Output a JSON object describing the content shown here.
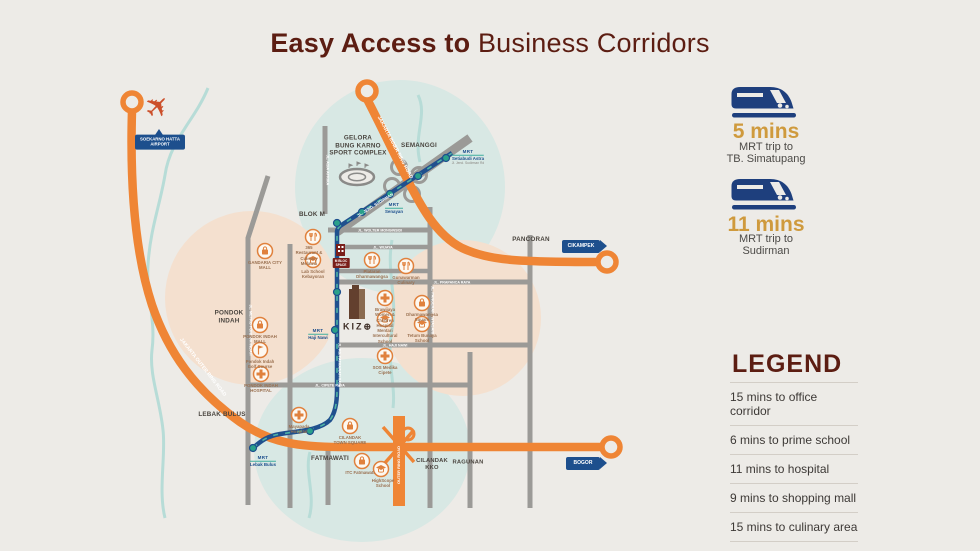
{
  "title": {
    "bold": "Easy Access to",
    "regular": "Business Corridors"
  },
  "right_panel": {
    "trips": [
      {
        "duration": "5 mins",
        "line1": "MRT trip to",
        "line2": "TB. Simatupang",
        "icon": "train-icon"
      },
      {
        "duration": "11 mins",
        "line1": "MRT trip to",
        "line2": "Sudirman",
        "icon": "train-icon"
      }
    ],
    "legend": {
      "heading": "LEGEND",
      "items": [
        "15 mins to office corridor",
        "6 mins to prime school",
        "11 mins to hospital",
        "9 mins to shopping mall",
        "15 mins to culinary area"
      ]
    }
  },
  "colors": {
    "maroon": "#5c1d12",
    "gold": "#cf9a3d",
    "navy": "#1d4f8d",
    "toll_orange": "#ef8535",
    "road_gray": "#9b9a97",
    "mrt_blue": "#20508e",
    "station_teal": "#2aa08a"
  },
  "map": {
    "icons": {
      "airplane": "✈"
    },
    "landmarks": {
      "gbk": [
        "GELORA",
        "BUNG KARNO",
        "SPORT COMPLEX"
      ],
      "semanggi": "SEMANGGI",
      "blok_m": "BLOK M",
      "pancoran": "PANCORAN",
      "pondok_indah": [
        "PONDOK",
        "INDAH"
      ],
      "lebak_bulus": "LEBAK BULUS",
      "fatmawati": "FATMAWATI",
      "cilandak_kko": [
        "CILANDAK",
        "KKO"
      ],
      "ragunan": "RAGUNAN"
    },
    "badges": {
      "airport_line1": "SOEKARNO HATTA",
      "airport_line2": "AIRPORT",
      "cikampek": "CIKAMPEK",
      "bogor": "BOGOR"
    },
    "roads": {
      "outer_ring": "JAKARTA OUTER RING ROAD",
      "inner_ring": "JAKARTA INNER RING ROAD",
      "outer_ring_south": "OUTER RING ROAD",
      "sudirman": "JL. JEND. SUDIRMAN",
      "asia_afrika": "JL. ASIA AFRIKA",
      "metro_pondok_indah": "JL. METRO PONDOK INDAH",
      "antasari": "JL. PANGERAN ANTASARI",
      "fatmawati_raya": "JL. RS. FATMAWATI RAYA",
      "wolter": "JL. WOLTER MONGINSIDI",
      "wijaya": "JL. WIJAYA",
      "prapanca": "JL. PRAPANCA RAYA",
      "haji_nawi": "JL. HAJI NAWI",
      "cipete": "JL. CIPETE RAYA"
    },
    "stations": [
      {
        "logo": "MRT",
        "name": "Setiabudi Astra",
        "sub": "Jl. Jend. Sudirman Rd"
      },
      {
        "logo": "MRT",
        "name": "Senayan"
      },
      {
        "logo": "MRT",
        "name": "Haji Nawi"
      },
      {
        "logo": "MRT",
        "name": "Lebak Bulus"
      }
    ],
    "kizu": {
      "name": "KIZ⊕"
    },
    "mbloc": {
      "line1": "M BLOC",
      "line2": "SPACE"
    },
    "pois": [
      {
        "label": "GANDARIA CITY MALL"
      },
      {
        "label": "365 Restaurant & Culinary Melawai"
      },
      {
        "label": "Lab School Kebayoran"
      },
      {
        "label": "Plataran Dharmawangsa"
      },
      {
        "label": "Gunawarman Culinary"
      },
      {
        "label": "Brawijaya Women & Children Hospital"
      },
      {
        "label": "Mentari Intercultural School"
      },
      {
        "label": "Dharmawangsa Square"
      },
      {
        "label": "Tetum Bunaya School"
      },
      {
        "label": "PONDOK INDAH MALL"
      },
      {
        "label": "Pondok Indah Golf Course"
      },
      {
        "label": "PONDOK INDAH HOSPITAL"
      },
      {
        "label": "SOS Medika Cipete"
      },
      {
        "label": "CILANDAK TOWN SQUARE"
      },
      {
        "label": "ITC Fatmawati"
      },
      {
        "label": "HighScope School"
      },
      {
        "label": "Mayapada Hospital"
      }
    ]
  }
}
